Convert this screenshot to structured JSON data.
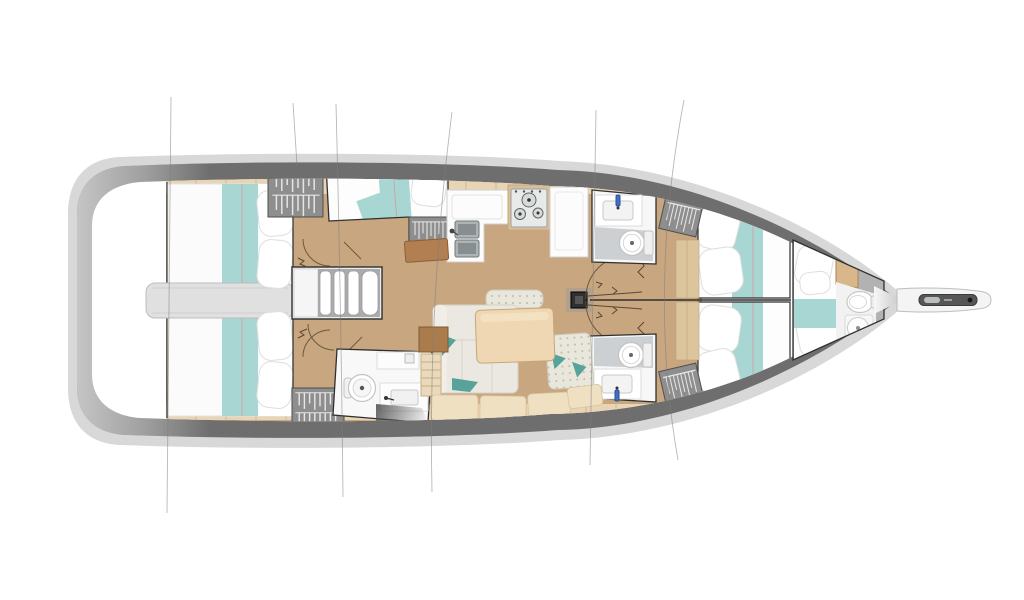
{
  "image": {
    "width": 1024,
    "height": 600,
    "background": "#ffffff",
    "description": "Top-view interior deck plan of a sailing yacht, bow pointing right, no visible text"
  },
  "palette": {
    "rim": "#d8d8d8",
    "deck": "#6e6e6e",
    "interior": "#ffffff",
    "wood": "#c8a680",
    "trim": "#e8d5b6",
    "trimline": "#c9b18c",
    "teal": "#a7d6d3",
    "piping": "#d69c9c",
    "locker": "#8e8e8e",
    "hanger": "#f0f0f0",
    "sofa": "#eae8e0",
    "dotted": "#e9e7dc",
    "accent": "#57a39c",
    "table": "#eed7b2",
    "brown": "#b17f51",
    "benchwood": "#efe0c2",
    "room": "#f7f7f7",
    "wetfloor": "#ccd0d2",
    "steel": "#aeb4b6",
    "stove": "#e8eaea",
    "faucet": "#3f6fc4",
    "border": "#2f2f2f",
    "arc": "#6b5a3f",
    "rigline": "#7d7d7d",
    "engine": "#e0e0e0",
    "graybow": "#b2b2b2"
  },
  "boat": {
    "orientation": "bow-right",
    "components": [
      {
        "id": "hull"
      },
      {
        "id": "side-deck-band"
      },
      {
        "id": "stern-platform"
      },
      {
        "id": "engine-compartment"
      },
      {
        "id": "aft-cabin-port"
      },
      {
        "id": "aft-cabin-starboard"
      },
      {
        "id": "companionway-stairs"
      },
      {
        "id": "midship-bunk-cabin"
      },
      {
        "id": "hanging-locker",
        "count": 5
      },
      {
        "id": "galley"
      },
      {
        "id": "galley-double-sink"
      },
      {
        "id": "galley-stove-3-burner"
      },
      {
        "id": "port-head"
      },
      {
        "id": "starboard-head"
      },
      {
        "id": "aft-starboard-wet-head"
      },
      {
        "id": "saloon-settee"
      },
      {
        "id": "saloon-table"
      },
      {
        "id": "chaise-cushion"
      },
      {
        "id": "mast"
      },
      {
        "id": "forward-cabin-port"
      },
      {
        "id": "forward-cabin-starboard"
      },
      {
        "id": "bow-cabin"
      },
      {
        "id": "bow-head"
      },
      {
        "id": "anchor-locker"
      },
      {
        "id": "bowsprit"
      },
      {
        "id": "rigging-lines",
        "count": 6
      }
    ]
  }
}
